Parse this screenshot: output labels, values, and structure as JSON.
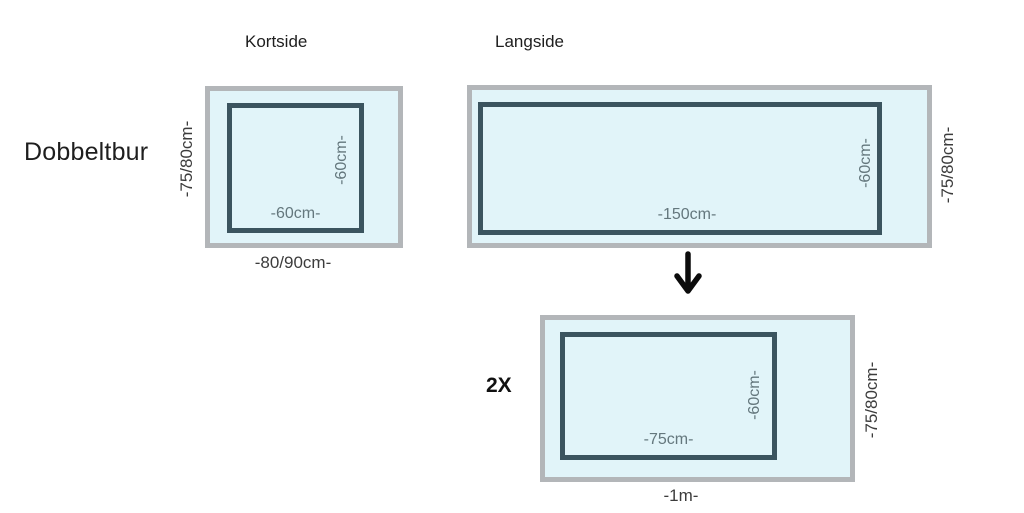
{
  "title": "Dobbeltbur",
  "colors": {
    "panel_fill": "#e1f4f9",
    "panel_border": "#b3b6b9",
    "frame_border": "#3b545f",
    "inner_dim_text": "#64777d",
    "outer_dim_text": "#3c3c3c",
    "title_text": "#1e1e1e"
  },
  "panels": {
    "kortside": {
      "title": "Kortside",
      "inner_width": "-60cm-",
      "inner_height": "-60cm-",
      "outer_height": "-75/80cm-",
      "outer_width": "-80/90cm-"
    },
    "langside": {
      "title": "Langside",
      "inner_width": "-150cm-",
      "inner_height": "-60cm-",
      "outer_height": "-75/80cm-"
    },
    "result": {
      "multiplier": "2X",
      "inner_width": "-75cm-",
      "inner_height": "-60cm-",
      "outer_height": "-75/80cm-",
      "outer_width": "-1m-"
    }
  },
  "icons": {
    "down_arrow": "↓"
  }
}
